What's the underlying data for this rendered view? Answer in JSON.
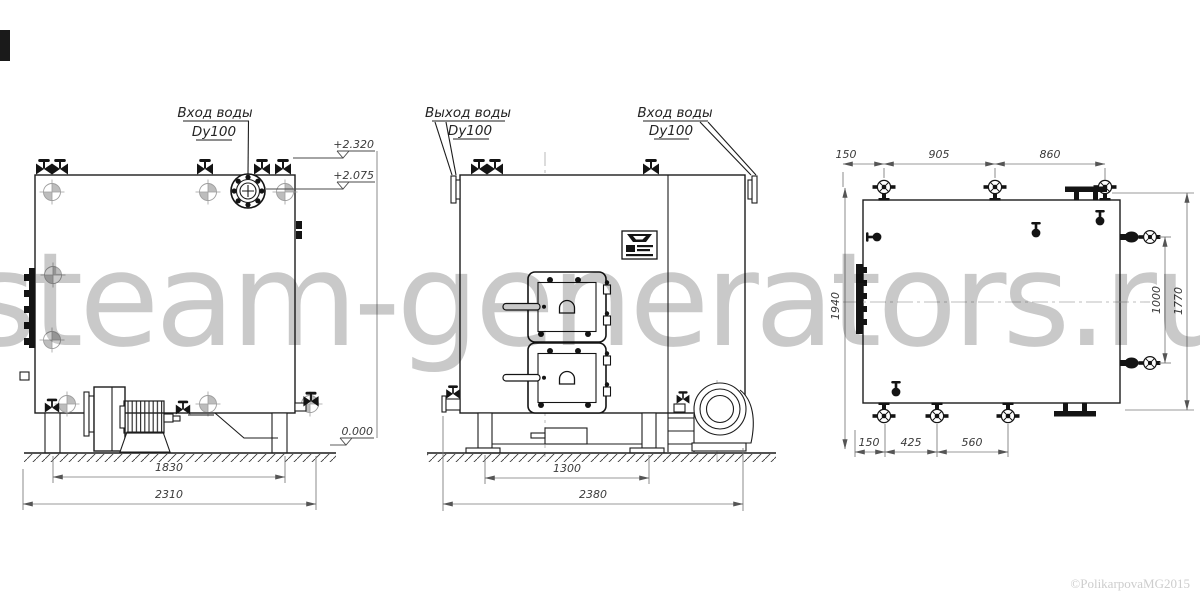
{
  "watermark": "steam-generators.ru",
  "copyright": "©PolikarpovaMG2015",
  "front": {
    "label": [
      "Вход воды",
      "Dy100"
    ],
    "elev_top": "+2.320",
    "elev_mid": "+2.075",
    "elev_zero": "0.000",
    "dim_inner": "1830",
    "dim_overall": "2310"
  },
  "rear": {
    "label_outlet": [
      "Выход воды",
      "Dy100"
    ],
    "label_inlet": [
      "Вход воды",
      "Dy100"
    ],
    "dim_inner": "1300",
    "dim_overall": "2380"
  },
  "plan": {
    "dim_top": [
      "150",
      "905",
      "860"
    ],
    "dim_bottom": [
      "150",
      "425",
      "560"
    ],
    "dim_left": "1940",
    "dim_right_inner": "1000",
    "dim_right_overall": "1770"
  }
}
